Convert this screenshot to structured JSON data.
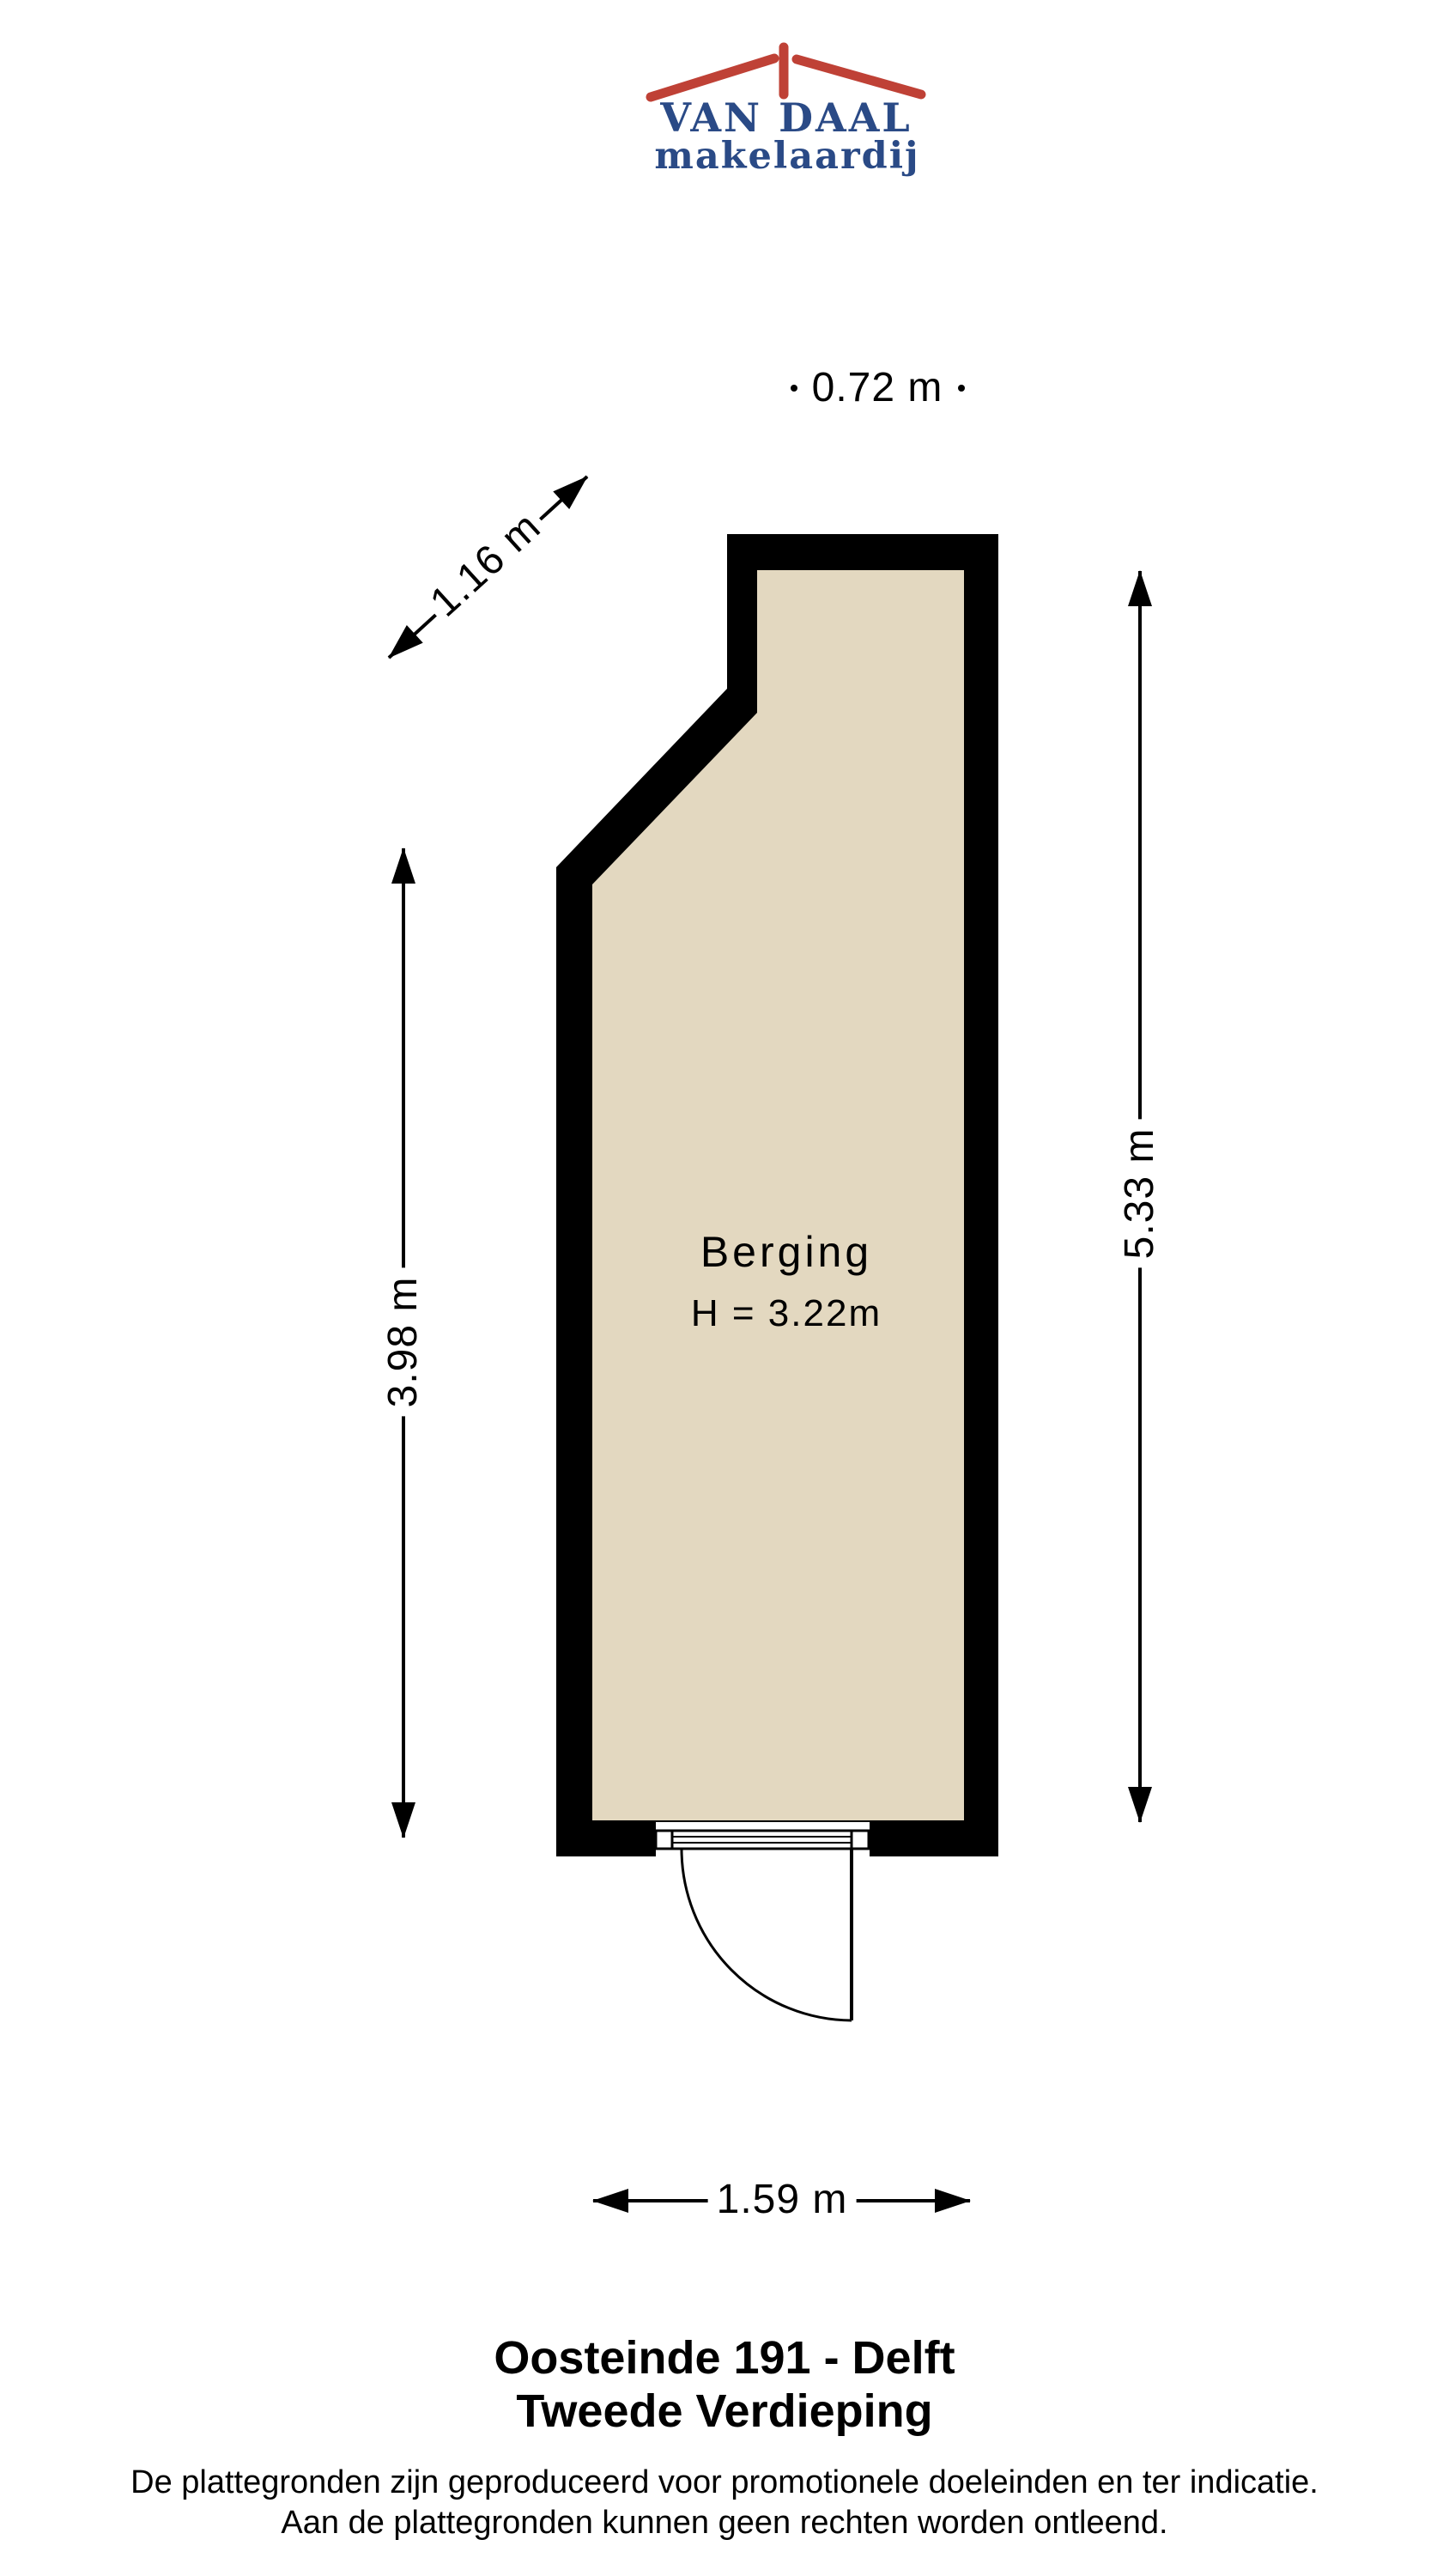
{
  "logo": {
    "name": "VAN DAAL",
    "subtitle": "makelaardij"
  },
  "plan": {
    "room": {
      "name": "Berging",
      "height_label": "H = 3.22m"
    },
    "dimensions": {
      "top": "0.72 m",
      "diagonal": "1.16 m",
      "left": "3.98 m",
      "right": "5.33 m",
      "bottom": "1.59 m"
    }
  },
  "footer": {
    "title_line1": "Oosteinde 191 - Delft",
    "title_line2": "Tweede Verdieping",
    "disclaimer_line1": "De plattegronden zijn geproduceerd voor promotionele doeleinden en ter indicatie.",
    "disclaimer_line2": "Aan de plattegronden kunnen geen rechten worden ontleend."
  },
  "colors": {
    "wall": "#000000",
    "floor": "#E3D8C0",
    "line": "#000000",
    "logo_red": "#BF4136",
    "logo_blue": "#2A4A86",
    "text": "#000000"
  }
}
